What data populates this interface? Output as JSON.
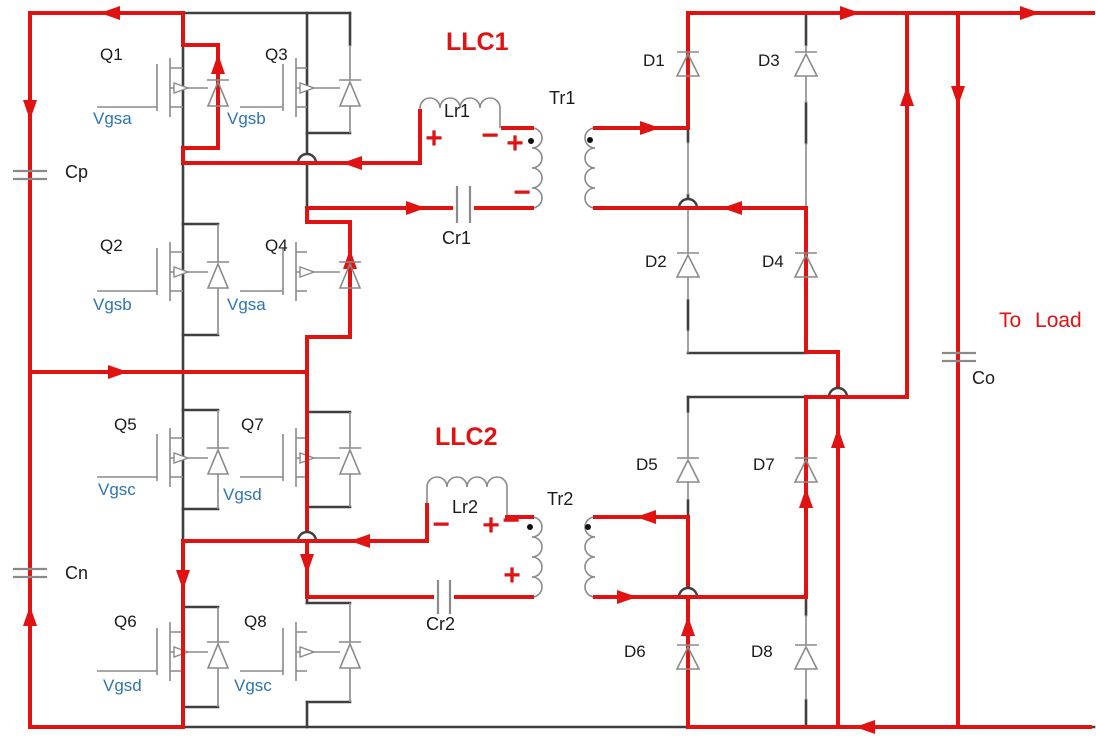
{
  "diagram": {
    "converter1": {
      "name": "LLC1",
      "inductor": "Lr1",
      "capacitor": "Cr1",
      "transformer": "Tr1"
    },
    "converter2": {
      "name": "LLC2",
      "inductor": "Lr2",
      "capacitor": "Cr2",
      "transformer": "Tr2"
    },
    "switches": [
      {
        "id": "Q1",
        "gate": "Vgsa"
      },
      {
        "id": "Q2",
        "gate": "Vgsb"
      },
      {
        "id": "Q3",
        "gate": "Vgsb"
      },
      {
        "id": "Q4",
        "gate": "Vgsa"
      },
      {
        "id": "Q5",
        "gate": "Vgsc"
      },
      {
        "id": "Q6",
        "gate": "Vgsd"
      },
      {
        "id": "Q7",
        "gate": "Vgsd"
      },
      {
        "id": "Q8",
        "gate": "Vgsc"
      }
    ],
    "diodes": [
      "D1",
      "D2",
      "D3",
      "D4",
      "D5",
      "D6",
      "D7",
      "D8"
    ],
    "input_capacitors": {
      "top": "Cp",
      "bottom": "Cn"
    },
    "output_capacitor": "Co",
    "load_label": "To Load",
    "polarity": {
      "plus": "+",
      "minus": "−"
    },
    "colors": {
      "current_path": "#e11212",
      "gate_label": "#2e74b5",
      "component": "#8a8a8a",
      "wire": "#3f3f3f",
      "background": "#ffffff"
    }
  }
}
